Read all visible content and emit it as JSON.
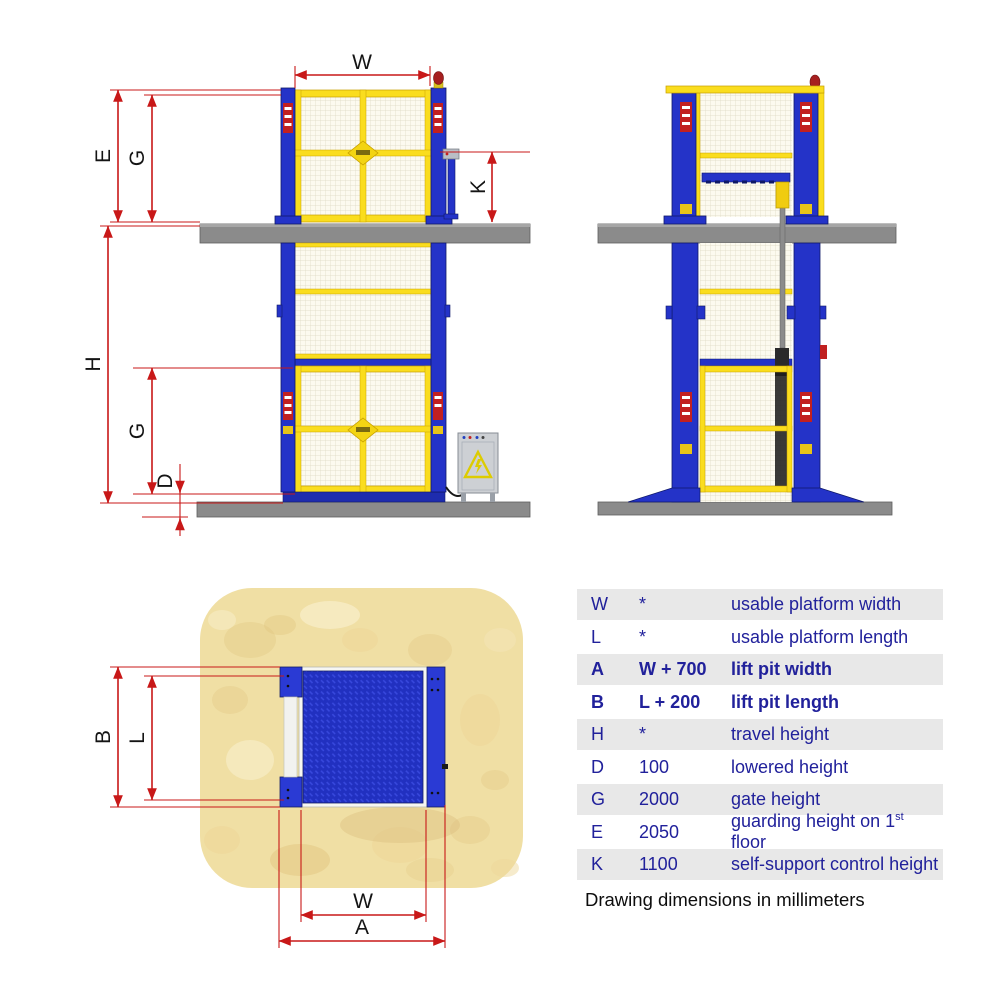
{
  "labels": {
    "W": "W",
    "E": "E",
    "G": "G",
    "H": "H",
    "D": "D",
    "K": "K",
    "B": "B",
    "L": "L",
    "A": "A"
  },
  "table": {
    "rows": [
      {
        "symbol": "W",
        "value": "*",
        "description": "usable platform width",
        "bold": false,
        "shaded": true
      },
      {
        "symbol": "L",
        "value": "*",
        "description": "usable platform length",
        "bold": false,
        "shaded": false
      },
      {
        "symbol": "A",
        "value": "W + 700",
        "description": "lift pit width",
        "bold": true,
        "shaded": true
      },
      {
        "symbol": "B",
        "value": "L + 200",
        "description": "lift pit length",
        "bold": true,
        "shaded": false
      },
      {
        "symbol": "H",
        "value": "*",
        "description": "travel height",
        "bold": false,
        "shaded": true
      },
      {
        "symbol": "D",
        "value": "100",
        "description": "lowered height",
        "bold": false,
        "shaded": false
      },
      {
        "symbol": "G",
        "value": "2000",
        "description": "gate height",
        "bold": false,
        "shaded": true
      },
      {
        "symbol": "E",
        "value": "2050",
        "description": "guarding height on 1st floor",
        "description_pre": "guarding height on 1",
        "description_sup": "st",
        "description_post": " floor",
        "bold": false,
        "shaded": false
      },
      {
        "symbol": "K",
        "value": "1100",
        "description": "self-support control height",
        "bold": false,
        "shaded": true
      }
    ],
    "note": "Drawing dimensions in millimeters"
  },
  "colors": {
    "dimension_red": "#c81818",
    "structure_blue": "#2433c8",
    "gate_yellow": "#fadd1e",
    "mesh_cream": "#fcfaef",
    "slab_gray": "#898989",
    "sand": "#f0dfa4",
    "platform_blue": "#2130c0",
    "table_text_blue": "#21219b",
    "table_row_shade": "#e8e8e8",
    "label_black": "#141414"
  }
}
